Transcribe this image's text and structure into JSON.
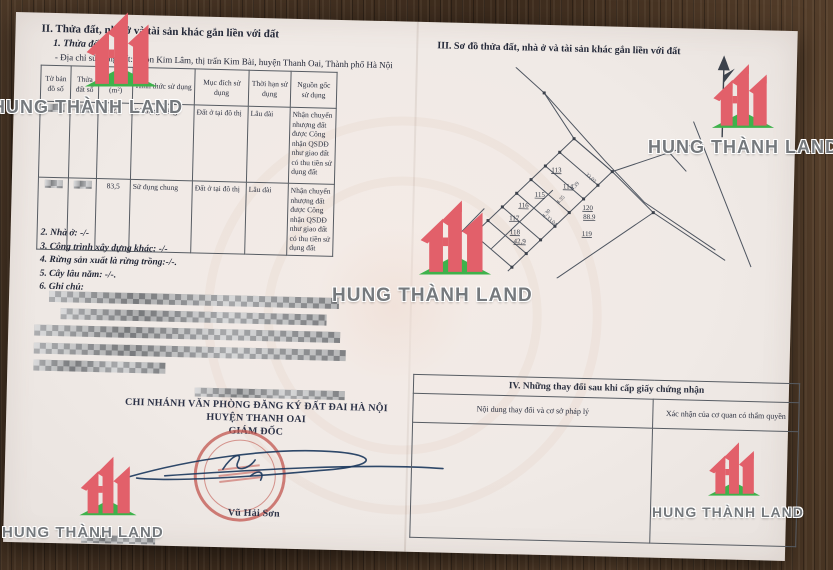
{
  "brand": {
    "name": "HUNG THÀNH LAND"
  },
  "certificate": {
    "section2": {
      "title": "II. Thửa đất, nhà ở và tài sản khác gắn liền với đất",
      "subtitle": "1. Thửa đất:",
      "address": "- Địa chỉ sử dụng đất: Thôn Kim Lâm, thị trấn Kim Bài, huyện Thanh Oai, Thành phố Hà Nội",
      "table": {
        "headers": [
          "Tờ bản đồ số",
          "Thửa đất số",
          "Diện tích (m²)",
          "Hình thức sử dụng",
          "Mục đích sử dụng",
          "Thời hạn sử dụng",
          "Nguồn gốc sử dụng"
        ],
        "rows": [
          {
            "area": "42,9",
            "form": "Sử dụng riêng",
            "purpose": "Đất ở tại đô thị",
            "term": "Lâu dài",
            "origin": "Nhận chuyển nhượng đất được Công nhận QSDĐ như giao đất có thu tiền sử dụng đất"
          },
          {
            "area": "83,5",
            "form": "Sử dụng chung",
            "purpose": "Đất ở tại đô thị",
            "term": "Lâu dài",
            "origin": "Nhận chuyển nhượng đất được Công nhận QSDĐ như giao đất có thu tiền sử dụng đất"
          }
        ]
      },
      "items": [
        "2. Nhà ở: -/-",
        "3. Công trình xây dựng khác: -/-",
        "4. Rừng sản xuất là rừng trồng:-/-.",
        "5. Cây lâu năm: -/-.",
        "6. Ghi chú:"
      ]
    },
    "section3": {
      "title": "III. Sơ đồ thửa đất, nhà ở và tài sản khác gắn liền với đất",
      "map_labels": [
        "113",
        "114",
        "115",
        "116",
        "117",
        "118",
        "42,9",
        "120",
        "88.9",
        "119",
        "33,03",
        "33,04",
        "4.39",
        "4.35",
        "4.30"
      ]
    },
    "section4": {
      "title": "IV. Những thay đổi sau khi cấp giấy chứng nhận",
      "col_content": "Nội dung thay đổi và cơ sở pháp lý",
      "col_confirm": "Xác nhận của cơ quan có thẩm quyền"
    },
    "signing": {
      "office1": "CHI NHÁNH VĂN PHÒNG ĐĂNG KÝ ĐẤT ĐAI HÀ NỘI",
      "office2": "HUYỆN THANH OAI",
      "role": "GIÁM ĐỐC",
      "signer": "Vũ Hải Sơn"
    }
  },
  "colors": {
    "logo_red": "#e2606a",
    "logo_green": "#3eb24b",
    "stamp_red": "#c2564f",
    "ink_blue": "#1d3a5e"
  }
}
